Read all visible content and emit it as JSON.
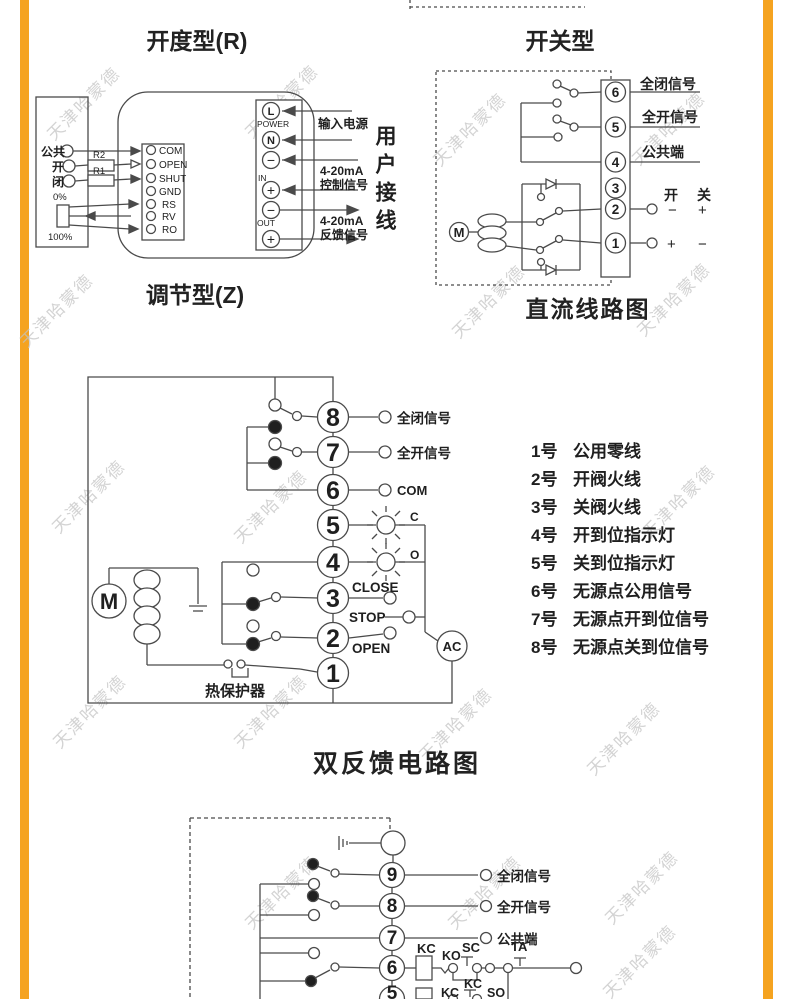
{
  "page": {
    "watermark": "天津哈蒙德",
    "accent_color": "#F5A320"
  },
  "titles": {
    "regulating_top": "开度型(R)",
    "regulating_bottom": "调节型(Z)",
    "switching_top": "开关型",
    "switching_bottom": "直流线路图",
    "double_feedback": "双反馈电路图"
  },
  "regulating": {
    "inputs": {
      "common": "公共",
      "open": "开",
      "close": "闭"
    },
    "resistors": {
      "r2": "R2",
      "r1": "R1"
    },
    "pot": {
      "top": "0%",
      "bottom": "100%"
    },
    "terminals": [
      "COM",
      "OPEN",
      "SHUT",
      "GND",
      "RS",
      "RV",
      "RO"
    ],
    "power_strip": {
      "l": "L",
      "power": "POWER",
      "n": "N",
      "minus": "−",
      "plus": "+",
      "in": "IN",
      "out": "OUT"
    },
    "annotations": {
      "supply": "输入电源",
      "range1": "4-20mA",
      "control": "控制信号",
      "range2": "4-20mA",
      "feedback": "反馈信号",
      "user_wiring": "用户接线"
    }
  },
  "switching": {
    "terminals": [
      "6",
      "5",
      "4",
      "3",
      "2",
      "1"
    ],
    "signals": {
      "full_close": "全闭信号",
      "full_open": "全开信号",
      "common": "公共端"
    },
    "open_label": "开",
    "close_label": "关",
    "polarity": {
      "row2_minus": "−",
      "row2_plus": "+",
      "row1_plus": "+",
      "row1_minus": "−"
    },
    "motor": "M"
  },
  "double_feedback": {
    "terminals": [
      "8",
      "7",
      "6",
      "5",
      "4",
      "3",
      "2",
      "1"
    ],
    "signals": {
      "full_close": "全闭信号",
      "full_open": "全开信号",
      "com": "COM",
      "c": "C",
      "o": "O",
      "close": "CLOSE",
      "stop": "STOP",
      "open": "OPEN"
    },
    "motor": "M",
    "ac": "AC",
    "thermal": "热保护器",
    "legend": [
      {
        "num": "1号",
        "label": "公用零线"
      },
      {
        "num": "2号",
        "label": "开阀火线"
      },
      {
        "num": "3号",
        "label": "关阀火线"
      },
      {
        "num": "4号",
        "label": "开到位指示灯"
      },
      {
        "num": "5号",
        "label": "关到位指示灯"
      },
      {
        "num": "6号",
        "label": "无源点公用信号"
      },
      {
        "num": "7号",
        "label": "无源点开到位信号"
      },
      {
        "num": "8号",
        "label": "无源点关到位信号"
      }
    ]
  },
  "bottom_diagram": {
    "terminals": [
      "9",
      "8",
      "7",
      "6",
      "5"
    ],
    "signals": {
      "full_close": "全闭信号",
      "full_open": "全开信号",
      "common": "公共端"
    },
    "relays": {
      "kc": "KC",
      "ko": "KO",
      "sc": "SC",
      "ta": "TA",
      "kc2": "KC",
      "kc3": "KC",
      "so": "SO"
    }
  }
}
